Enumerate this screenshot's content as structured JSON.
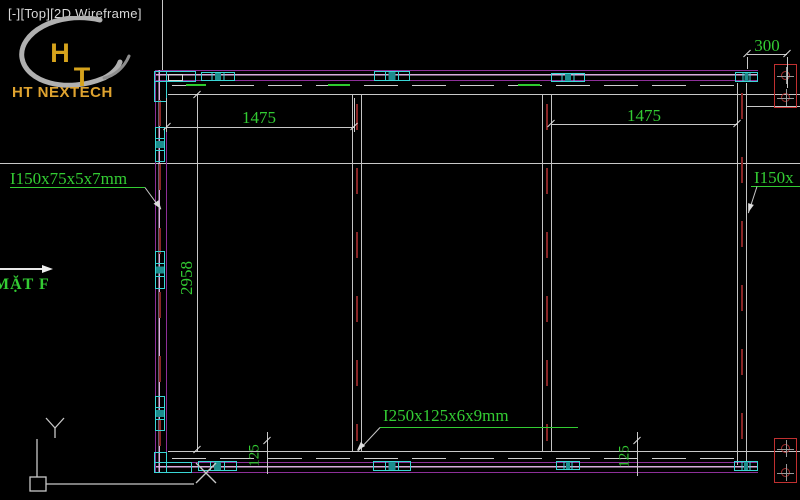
{
  "viewport_controls": {
    "minimize": "[-]",
    "view": "[Top]",
    "visual_style": "[2D Wireframe]"
  },
  "logo": {
    "monogram_h": "H",
    "monogram_t": "T",
    "company": "HT NEXTECH"
  },
  "view_marker": {
    "label": "MẶT F"
  },
  "member_labels": {
    "left_column": "I150x75x5x7mm",
    "right_column": "I150x",
    "bottom_beam": "I250x125x6x9mm"
  },
  "dimensions": {
    "top_left_bay": "1475",
    "top_right_bay": "1475",
    "frame_height": "2958",
    "right_edge_offset": "300",
    "bottom_left_flange": "125",
    "bottom_right_flange": "125"
  },
  "icons": {
    "ucs": "ucs-axis-icon",
    "bolt": "bolt-hole-symbol",
    "connector": "splice-plate-symbol",
    "section_arrow": "view-direction-arrow"
  },
  "colors": {
    "background": "#000000",
    "annotation_green": "#33cc33",
    "frame_magenta": "#8d2f99",
    "frame_pink": "#d9aede",
    "detail_cyan": "#3ad6d6",
    "bolt_red": "#c03030",
    "centerline_red": "#8a2626",
    "line_gray": "#c8c8c8",
    "logo_gold": "#d6a31c"
  }
}
